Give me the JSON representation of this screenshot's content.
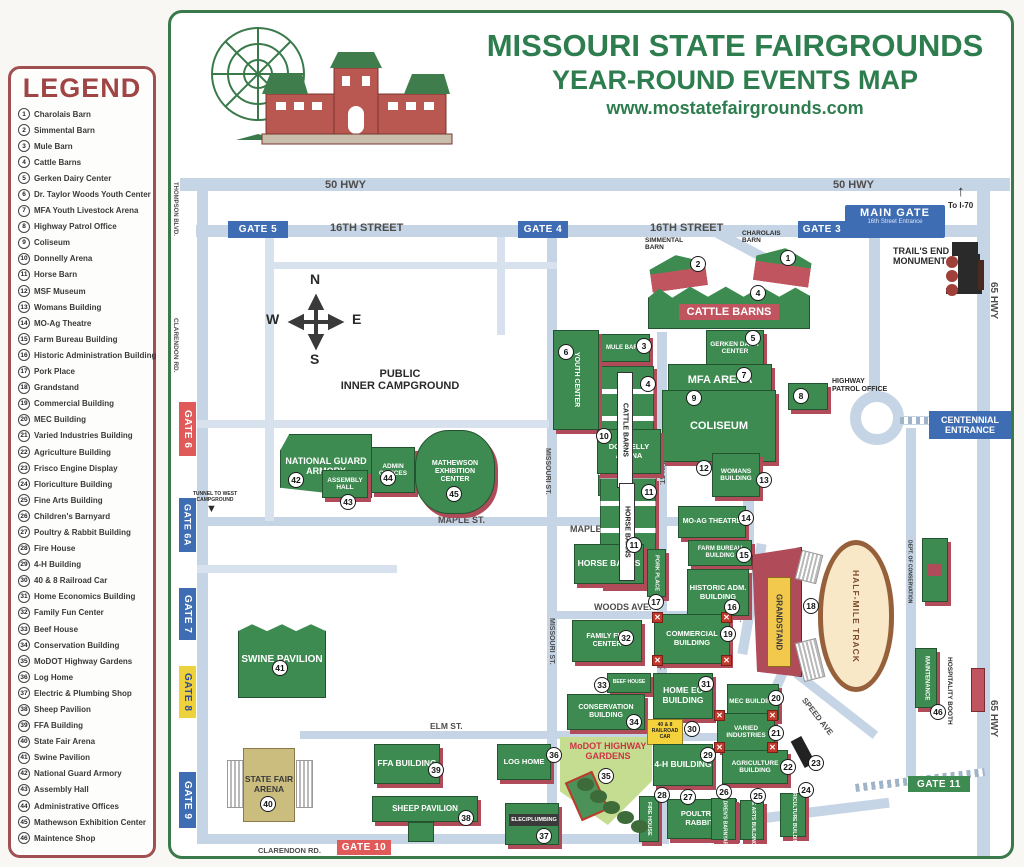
{
  "colors": {
    "title_green": "#2d7d4e",
    "building_green": "#3d8b50",
    "building_red": "#b04b59",
    "road_blue": "#c6d5e5",
    "legend_maroon": "#a04545",
    "gate_blue": "#3f6db4",
    "gate_red": "#e05a5a",
    "gate_yellow": "#efd13c",
    "gate_green": "#3d8b50",
    "campground_purple": "#6b4fa5",
    "track_tan": "#f8e8c8",
    "grandstand_yellow": "#f2c94c",
    "arena_tan": "#cbbd7e",
    "modot_green": "#c4dd90",
    "modot_text_red": "#cc3344"
  },
  "header": {
    "title": "MISSOURI STATE FAIRGROUNDS",
    "subtitle": "YEAR-ROUND EVENTS MAP",
    "website": "www.mostatefairgrounds.com"
  },
  "legend": {
    "title": "LEGEND",
    "items": [
      {
        "num": "1",
        "label": "Charolais Barn"
      },
      {
        "num": "2",
        "label": "Simmental Barn"
      },
      {
        "num": "3",
        "label": "Mule Barn"
      },
      {
        "num": "4",
        "label": "Cattle Barns"
      },
      {
        "num": "5",
        "label": "Gerken Dairy Center"
      },
      {
        "num": "6",
        "label": "Dr. Taylor Woods Youth Center"
      },
      {
        "num": "7",
        "label": "MFA Youth Livestock Arena"
      },
      {
        "num": "8",
        "label": "Highway Patrol Office"
      },
      {
        "num": "9",
        "label": "Coliseum"
      },
      {
        "num": "10",
        "label": "Donnelly Arena"
      },
      {
        "num": "11",
        "label": "Horse Barn"
      },
      {
        "num": "12",
        "label": "MSF Museum"
      },
      {
        "num": "13",
        "label": "Womans Building"
      },
      {
        "num": "14",
        "label": "MO-Ag Theatre"
      },
      {
        "num": "15",
        "label": "Farm Bureau Building"
      },
      {
        "num": "16",
        "label": "Historic Administration Building"
      },
      {
        "num": "17",
        "label": "Pork Place"
      },
      {
        "num": "18",
        "label": "Grandstand"
      },
      {
        "num": "19",
        "label": "Commercial Building"
      },
      {
        "num": "20",
        "label": "MEC Building"
      },
      {
        "num": "21",
        "label": "Varied Industries Building"
      },
      {
        "num": "22",
        "label": "Agriculture Building"
      },
      {
        "num": "23",
        "label": "Frisco Engine Display"
      },
      {
        "num": "24",
        "label": "Floriculture Building"
      },
      {
        "num": "25",
        "label": "Fine Arts Building"
      },
      {
        "num": "26",
        "label": "Children's Barnyard"
      },
      {
        "num": "27",
        "label": "Poultry & Rabbit Building"
      },
      {
        "num": "28",
        "label": "Fire House"
      },
      {
        "num": "29",
        "label": "4-H Building"
      },
      {
        "num": "30",
        "label": "40 & 8 Railroad Car"
      },
      {
        "num": "31",
        "label": "Home Economics Building"
      },
      {
        "num": "32",
        "label": "Family Fun Center"
      },
      {
        "num": "33",
        "label": "Beef House"
      },
      {
        "num": "34",
        "label": "Conservation Building"
      },
      {
        "num": "35",
        "label": "MoDOT Highway Gardens"
      },
      {
        "num": "36",
        "label": "Log Home"
      },
      {
        "num": "37",
        "label": "Electric & Plumbing Shop"
      },
      {
        "num": "38",
        "label": "Sheep Pavilion"
      },
      {
        "num": "39",
        "label": "FFA Building"
      },
      {
        "num": "40",
        "label": "State Fair Arena"
      },
      {
        "num": "41",
        "label": "Swine Pavilion"
      },
      {
        "num": "42",
        "label": "National Guard Armory"
      },
      {
        "num": "43",
        "label": "Assembly Hall"
      },
      {
        "num": "44",
        "label": "Administrative Offices"
      },
      {
        "num": "45",
        "label": "Mathewson Exhibition Center"
      },
      {
        "num": "46",
        "label": "Maintence Shop"
      }
    ]
  },
  "map": {
    "streets": {
      "hwy50": "50 HWY",
      "st16": "16TH STREET",
      "thompson": "THOMPSON BLVD.",
      "clarendon": "CLARENDON RD.",
      "hwy65": "65 HWY",
      "missouri": "MISSOURI ST.",
      "main": "MAIN ST.",
      "msf": "MSF BLVD.",
      "maple": "MAPLE ST.",
      "elm": "ELM ST.",
      "elm2": "ELM ST",
      "woods": "WOODS AVE.",
      "show": "SHOW AVE.",
      "speed": "SPEED AVE"
    },
    "gates": {
      "g5": "GATE 5",
      "g4": "GATE 4",
      "g3": "GATE 3",
      "g6": "GATE 6",
      "g6a": "GATE 6A",
      "g7": "GATE 7",
      "g8": "GATE 8",
      "g9": "GATE 9",
      "g10": "GATE 10",
      "g11": "GATE 11",
      "main_gate": "MAIN GATE",
      "main_gate_sub": "16th Street Entrance",
      "centennial": "CENTENNIAL ENTRANCE"
    },
    "notes": {
      "to_i70": "To I-70",
      "i70_arrow": "↑",
      "trails_end": "TRAIL'S END MONUMENT",
      "tunnel": "TUNNEL TO WEST CAMPGROUND",
      "tunnel_arrow": "▼",
      "campground_1": "PUBLIC",
      "campground_2": "INNER CAMPGROUND",
      "compass_n": "N",
      "compass_e": "E",
      "compass_s": "S",
      "compass_w": "W"
    },
    "buildings": {
      "charolais": {
        "label": "CHAROLAIS BARN",
        "num": "1"
      },
      "simmental": {
        "label": "SIMMENTAL BARN",
        "num": "2"
      },
      "cattle": {
        "label": "CATTLE BARNS",
        "num": "4"
      },
      "mule": {
        "label": "MULE BARN",
        "num": "3"
      },
      "youth": {
        "label": "YOUTH CENTER",
        "num": "6"
      },
      "gerken": {
        "label": "GERKEN DAIRY CENTER",
        "num": "5"
      },
      "mfa": {
        "label": "MFA ARENA",
        "num": "7"
      },
      "coliseum": {
        "label": "COLISEUM",
        "num": "9"
      },
      "patrol": {
        "label": "HIGHWAY PATROL OFFICE",
        "num": "8"
      },
      "donnelly": {
        "label": "DONNELLY ARENA",
        "num": "10"
      },
      "horse": {
        "label": "HORSE BARNS",
        "num": "11"
      },
      "womans": {
        "label": "WOMANS BUILDING",
        "num": "12",
        "num2": "13"
      },
      "moag": {
        "label": "MO-AG THEATRE",
        "num": "14"
      },
      "farm_bureau": {
        "label": "FARM BUREAU BUILDING",
        "num": "15"
      },
      "historic": {
        "label": "HISTORIC ADM. BUILDING",
        "num": "16"
      },
      "pork": {
        "label": "PORK PLACE",
        "num": "17"
      },
      "grandstand": {
        "label": "GRANDSTAND",
        "num": "18"
      },
      "track": {
        "label": "HALF-MILE TRACK"
      },
      "family_fun": {
        "label": "FAMILY FUN CENTER",
        "num": "32"
      },
      "commercial": {
        "label": "COMMERCIAL BUILDING",
        "num": "19",
        "corner": "✕"
      },
      "beef": {
        "label": "BEEF HOUSE",
        "num": "33"
      },
      "home_ec": {
        "label": "HOME EC BUILDING",
        "num": "31"
      },
      "mec": {
        "label": "MEC BUILDING",
        "num": "20"
      },
      "conservation": {
        "label": "CONSERVATION BUILDING",
        "num": "34"
      },
      "varied": {
        "label": "VARIED INDUSTRIES",
        "num": "21",
        "corner": "✕"
      },
      "railroad": {
        "label": "40 & 8 RAILROAD CAR",
        "num": "30"
      },
      "modot": {
        "label": "MoDOT HIGHWAY GARDENS",
        "num": "35"
      },
      "fourh": {
        "label": "4-H BUILDING",
        "num": "29"
      },
      "agriculture": {
        "label": "AGRICULTURE BUILDING",
        "num": "22"
      },
      "frisco": {
        "num": "23"
      },
      "firehouse": {
        "label": "FIRE HOUSE",
        "num": "28"
      },
      "poultry": {
        "label": "POULTRY & RABBITS",
        "num": "27"
      },
      "childrens": {
        "label": "CHILDREN'S BARNYARD",
        "num": "26"
      },
      "finearts": {
        "label": "FINE ARTS BUILDING",
        "num": "25"
      },
      "floriculture": {
        "label": "FLORICULTURE BUILDING",
        "num": "24"
      },
      "dept_cons": {
        "label": "DEPT. OF CONSERVATION"
      },
      "maintenance": {
        "label": "MAINTENANCE",
        "num": "46"
      },
      "hospitality": {
        "label": "HOSPITALITY BOOTH"
      },
      "swine": {
        "label": "SWINE PAVILION",
        "num": "41"
      },
      "arena": {
        "label": "STATE FAIR ARENA",
        "num": "40"
      },
      "ffa": {
        "label": "FFA BUILDING",
        "num": "39"
      },
      "sheep": {
        "label": "SHEEP PAVILION",
        "num": "38"
      },
      "log": {
        "label": "LOG HOME",
        "num": "36"
      },
      "elec": {
        "label": "ELEC/PLUMBING",
        "num": "37"
      },
      "armory": {
        "label": "NATIONAL GUARD ARMORY",
        "num": "42"
      },
      "assembly": {
        "label": "ASSEMBLY HALL",
        "num": "43"
      },
      "admin": {
        "label": "ADMIN OFFICES",
        "num": "44"
      },
      "mathewson": {
        "label": "MATHEWSON EXHIBITION CENTER",
        "num": "45"
      }
    }
  }
}
